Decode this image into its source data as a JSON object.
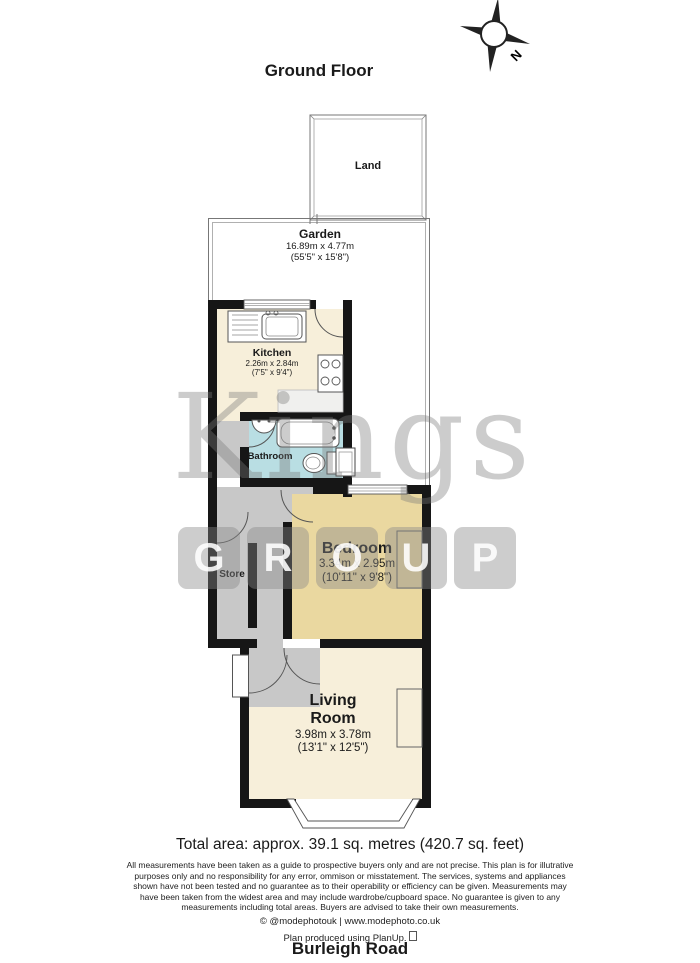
{
  "title": "Ground Floor",
  "compass": {
    "label": "N"
  },
  "rooms": {
    "land": {
      "name": "Land"
    },
    "garden": {
      "name": "Garden",
      "dims_metric": "16.89m x 4.77m",
      "dims_imperial": "(55'5\" x 15'8\")"
    },
    "kitchen": {
      "name": "Kitchen",
      "dims_metric": "2.26m x 2.84m",
      "dims_imperial": "(7'5\" x 9'4\")"
    },
    "bathroom": {
      "name": "Bathroom"
    },
    "store": {
      "name": "Store"
    },
    "bedroom": {
      "name": "Bedroom",
      "dims_metric": "3.34m x 2.95m",
      "dims_imperial": "(10'11\" x 9'8\")"
    },
    "living_room": {
      "name_line1": "Living",
      "name_line2": "Room",
      "dims_metric": "3.98m x 3.78m",
      "dims_imperial": "(13'1\" x 12'5\")"
    }
  },
  "summary": {
    "total_area": "Total area: approx. 39.1 sq. metres (420.7 sq. feet)"
  },
  "disclaimer": {
    "line1": "All measurements have been taken as a guide to prospective buyers only and are not precise. This plan is for illutrative",
    "line2": "purposes only and no responsibility for any error, ommison or misstatement. The services, systems and appliances",
    "line3": "shown have not been tested and no guarantee as to their operability or efficiency can be given. Measurements may",
    "line4": "have been taken from the widest area and may include wardrobe/cupboard space. No guarantee is given to any",
    "line5": "measurements including total areas. Buyers are advised to take their own measurements."
  },
  "footer": {
    "credit": "© @modephotouk | www.modephoto.co.uk",
    "produced": "Plan produced using PlanUp.",
    "address": "Burleigh Road"
  },
  "watermark": {
    "word": "Kings",
    "letters": [
      "G",
      "R",
      "O",
      "U",
      "P"
    ]
  },
  "colors": {
    "wall": "#161616",
    "kitchen_floor": "#f7efda",
    "bedroom_floor": "#ead8a0",
    "bathroom_floor": "#b9dee3",
    "hall_floor": "#c8c8c8"
  }
}
